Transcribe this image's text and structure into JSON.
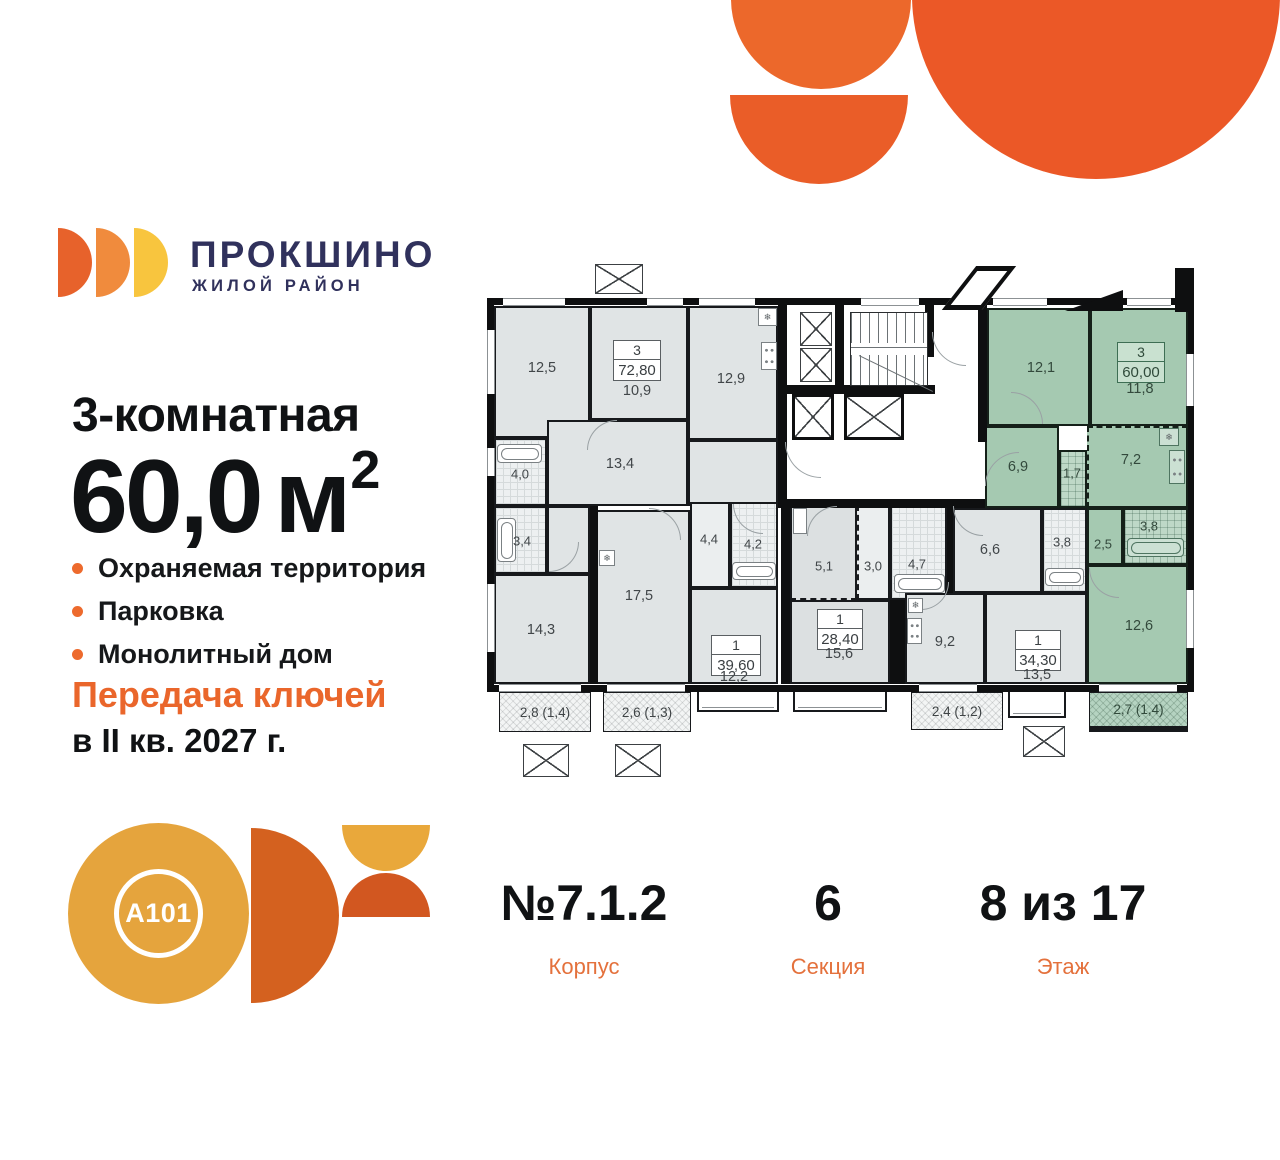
{
  "colors": {
    "accent_orange": "#ED6A2D",
    "brand_navy": "#30315C",
    "highlight_green": "#A5C9B1",
    "deco_orange": "#EB5827",
    "a101_gold": "#E5A43D",
    "a101_orange": "#D4611F"
  },
  "brand": {
    "name": "ПРОКШИНО",
    "tagline": "ЖИЛОЙ РАЙОН"
  },
  "offer": {
    "type": "3-комнатная",
    "area": "60,0",
    "area_unit": "м",
    "area_sup": "2",
    "features": [
      "Охраняемая территория",
      "Парковка",
      "Монолитный дом"
    ],
    "keys_title": "Передача ключей",
    "keys_date": "в II кв. 2027 г."
  },
  "developer": {
    "logo_text": "A101"
  },
  "stats": {
    "building": {
      "value": "№7.1.2",
      "label": "Корпус"
    },
    "section": {
      "value": "6",
      "label": "Секция"
    },
    "floor": {
      "value": "8 из 17",
      "label": "Этаж"
    }
  },
  "plan": {
    "icons": {
      "snowflake": "❄"
    },
    "apartments": [
      {
        "badge": {
          "rooms": "3",
          "area": "72,80"
        },
        "rooms": {
          "r125": "12,5",
          "r109": "10,9",
          "r129": "12,9",
          "r134": "13,4",
          "r40": "4,0",
          "r34": "3,4",
          "r143": "14,3"
        },
        "balcony": "2,8 (1,4)"
      },
      {
        "badge": {
          "rooms": "1",
          "area": "39,60"
        },
        "rooms": {
          "r175": "17,5",
          "r44": "4,4",
          "r42": "4,2",
          "r122": "12,2"
        },
        "balcony": "2,6 (1,3)"
      },
      {
        "badge": {
          "rooms": "1",
          "area": "28,40"
        },
        "rooms": {
          "r51": "5,1",
          "r30": "3,0",
          "r47": "4,7",
          "r156": "15,6"
        }
      },
      {
        "badge": {
          "rooms": "1",
          "area": "34,30"
        },
        "rooms": {
          "r66": "6,6",
          "r38": "3,8",
          "r92": "9,2",
          "r135": "13,5"
        },
        "balcony": "2,4 (1,2)"
      },
      {
        "badge": {
          "rooms": "3",
          "area": "60,00"
        },
        "highlighted": true,
        "rooms": {
          "r121": "12,1",
          "r118": "11,8",
          "r69": "6,9",
          "r17": "1,7",
          "r72": "7,2",
          "r25": "2,5",
          "r38": "3,8",
          "r126": "12,6"
        },
        "balcony": "2,7 (1,4)"
      }
    ]
  }
}
